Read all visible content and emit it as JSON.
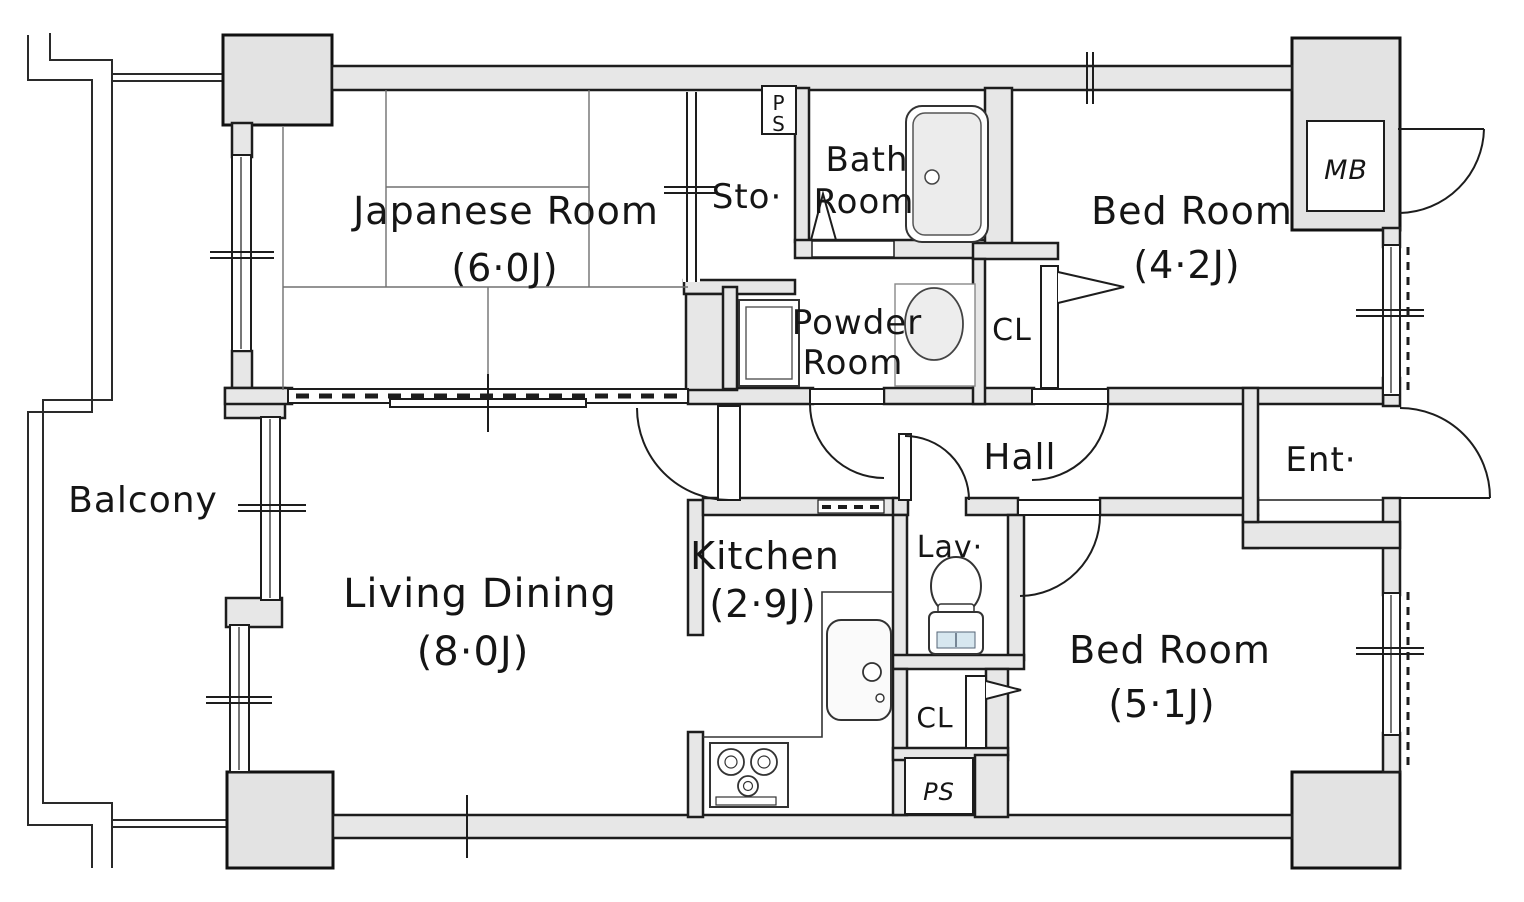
{
  "plan": {
    "type": "apartment-floor-plan",
    "colors": {
      "wall_fill": "#e7e7e7",
      "outline": "#1d1d1d",
      "fixture": "#333333",
      "toilet_tint": "#d7e7ef"
    },
    "rooms": {
      "balcony": {
        "label": "Balcony"
      },
      "japanese_room": {
        "label": "Japanese Room",
        "size": "(6·0J)"
      },
      "storage": {
        "label": "Sto·"
      },
      "pipe_shaft_top": {
        "letter_top": "P",
        "letter_bottom": "S"
      },
      "bath_room": {
        "label_line1": "Bath",
        "label_line2": "Room"
      },
      "powder_room": {
        "label_line1": "Powder",
        "label_line2": "Room"
      },
      "closet_upper": {
        "label": "CL"
      },
      "bedroom_north": {
        "label": "Bed Room",
        "size": "(4·2J)"
      },
      "meter_box": {
        "label": "MB"
      },
      "hall": {
        "label": "Hall"
      },
      "entrance": {
        "label": "Ent·"
      },
      "lavatory": {
        "label": "Lav·"
      },
      "kitchen": {
        "label": "Kitchen",
        "size": "(2·9J)"
      },
      "living_dining": {
        "label": "Living Dining",
        "size": "(8·0J)"
      },
      "closet_lower": {
        "label": "CL"
      },
      "pipe_shaft_bottom": {
        "label": "PS"
      },
      "bedroom_south": {
        "label": "Bed Room",
        "size": "(5·1J)"
      }
    }
  }
}
